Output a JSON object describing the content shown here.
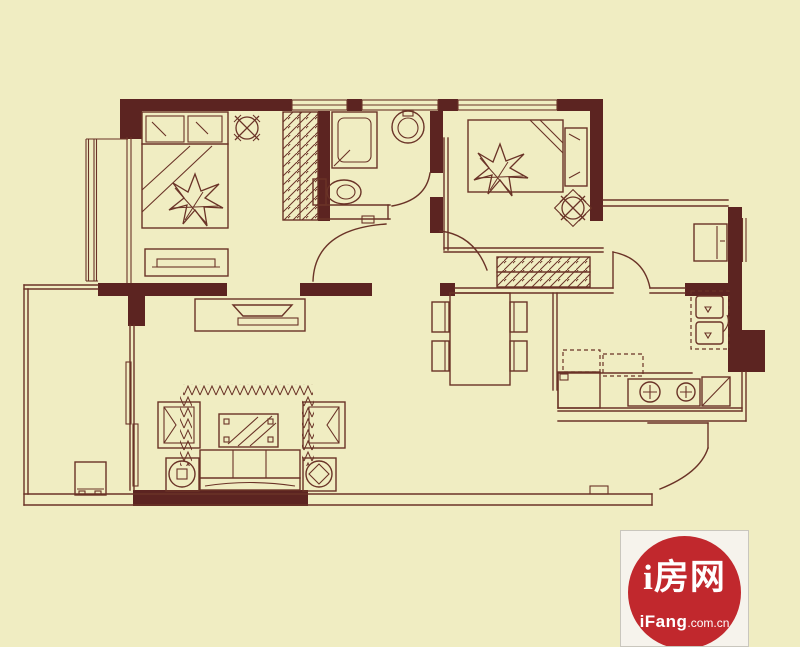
{
  "watermark": {
    "brand": "i房网",
    "domain_bold": "iFang",
    "domain_suffix": ".com.cn"
  },
  "colors": {
    "bg": "#f0edc2",
    "line": "#6a3327",
    "wall": "#5c2421",
    "logo-red": "#c1282d",
    "logo-box": "#f6f3ec",
    "logo-text": "#ffffff",
    "logo-border": "#c9c6bd"
  },
  "floor_plan": {
    "type": "apartment-floor-plan",
    "icons": [
      "double-bed-icon",
      "single-bed-icon",
      "pillow-icon",
      "flower-decor-icon",
      "dresser-icon",
      "wardrobe-icon",
      "ceiling-lamp-icon",
      "shower-icon",
      "toilet-icon",
      "washbasin-icon",
      "dining-table-icon",
      "dining-chair-icon",
      "closet-hatch-icon",
      "fridge-icon",
      "kitchen-sink-icon",
      "stove-icon",
      "washing-machine-icon",
      "counter-icon",
      "tv-cabinet-icon",
      "sofa-icon",
      "armchair-icon",
      "coffee-table-icon",
      "side-table-lamp-icon",
      "rug-icon",
      "balcony-cabinet-icon",
      "sliding-door-icon",
      "door-swing-arc",
      "window-symbol"
    ]
  }
}
